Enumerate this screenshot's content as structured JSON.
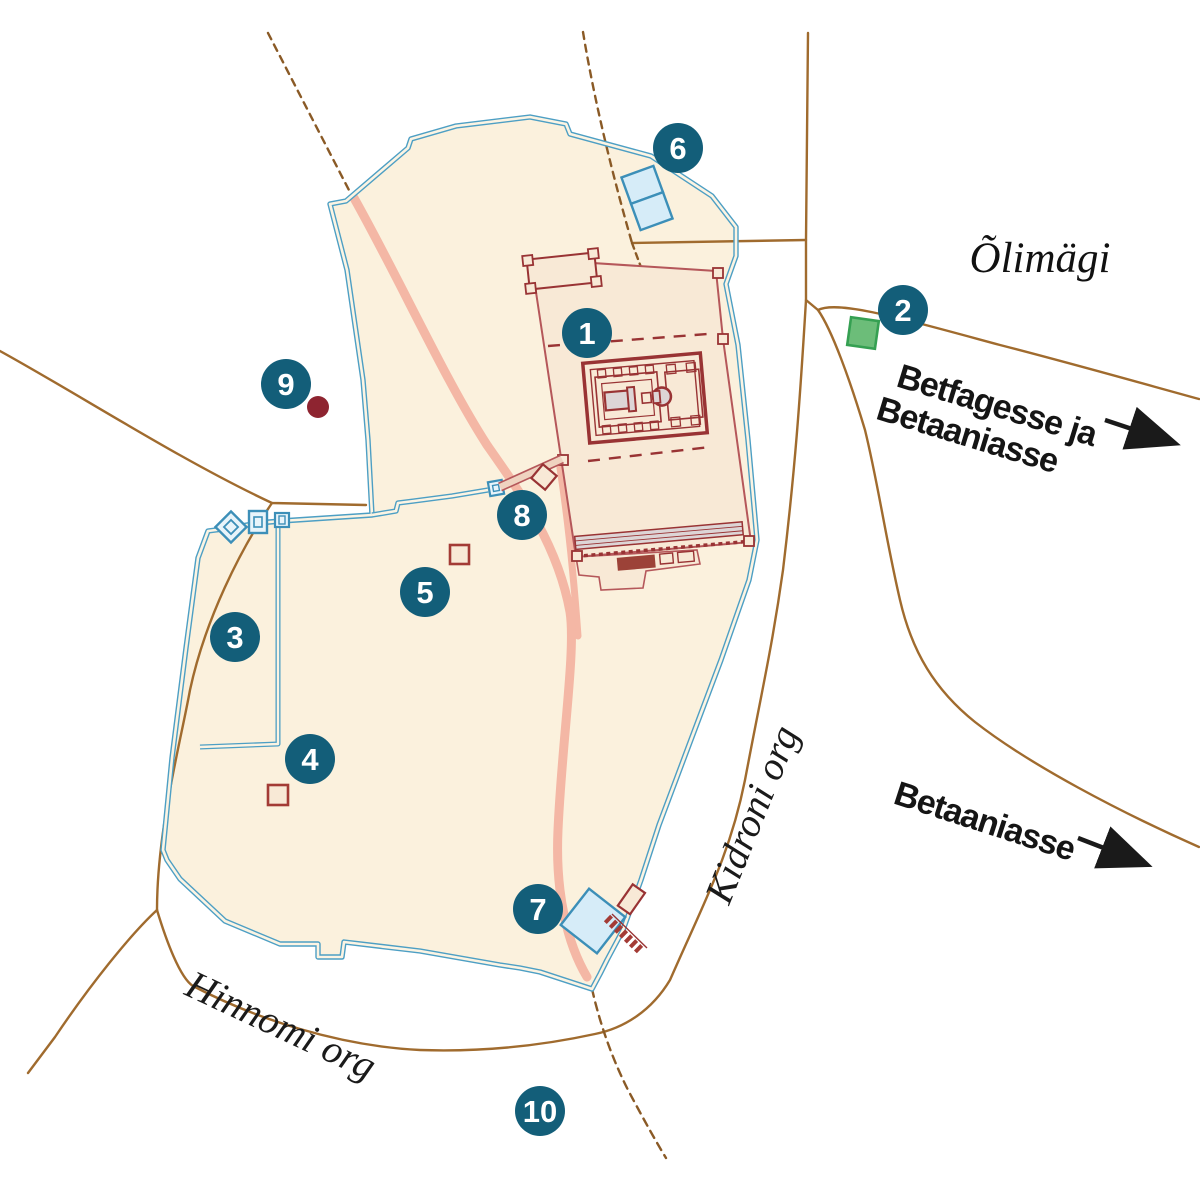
{
  "map": {
    "description": "Map of ancient Jerusalem with numbered sites, city walls, temple complex, valleys and roads",
    "labels": {
      "olive_mount": "Õlimägi",
      "bethphage_direction_line1": "Betfagesse ja",
      "bethphage_direction_line2": "Betaaniasse",
      "bethany_direction": "Betaaniasse",
      "kidron_valley": "Kidroni org",
      "hinnom_valley": "Hinnomi org"
    },
    "markers": [
      {
        "number": "1",
        "x": 587,
        "y": 333
      },
      {
        "number": "2",
        "x": 903,
        "y": 310
      },
      {
        "number": "3",
        "x": 235,
        "y": 637
      },
      {
        "number": "4",
        "x": 310,
        "y": 759
      },
      {
        "number": "5",
        "x": 425,
        "y": 592
      },
      {
        "number": "6",
        "x": 678,
        "y": 148
      },
      {
        "number": "7",
        "x": 538,
        "y": 909
      },
      {
        "number": "8",
        "x": 522,
        "y": 515
      },
      {
        "number": "9",
        "x": 286,
        "y": 384
      },
      {
        "number": "10",
        "x": 540,
        "y": 1111
      }
    ],
    "marker_style": {
      "radius": 25,
      "fill": "#135e79",
      "number_color": "#ffffff"
    },
    "features": {
      "green_square": {
        "name": "garden-site-square",
        "x": 863,
        "y": 333
      },
      "red_dot": {
        "name": "hill-site-dot",
        "x": 318,
        "y": 407
      },
      "small_squares": [
        {
          "name": "building-site-square",
          "x": 278,
          "y": 795
        },
        {
          "name": "building-site-square",
          "x": 459,
          "y": 554
        }
      ],
      "pools_north": {
        "name": "twin-pools"
      },
      "pool_south": {
        "name": "pool-of-siloam"
      }
    },
    "colors": {
      "city_fill": "#fbf1dd",
      "wall_blue": "#4d9fc4",
      "wall_gap": "#fcf4e3",
      "temple_fill": "#f8e9d6",
      "temple_red": "#993334",
      "platform_edge": "#b5575a",
      "road_brown": "#a06b2e",
      "road_dash_brown": "#8a5a26",
      "path_pink": "#f4b7a5",
      "pool_fill": "#d6ecf8",
      "pool_stroke": "#3c8fb8",
      "green_fill": "#6cbd79",
      "green_stroke": "#35a052",
      "dark_red": "#8e2430",
      "gray_building": "#ddd5d6",
      "text": "#1a1a1a"
    }
  }
}
